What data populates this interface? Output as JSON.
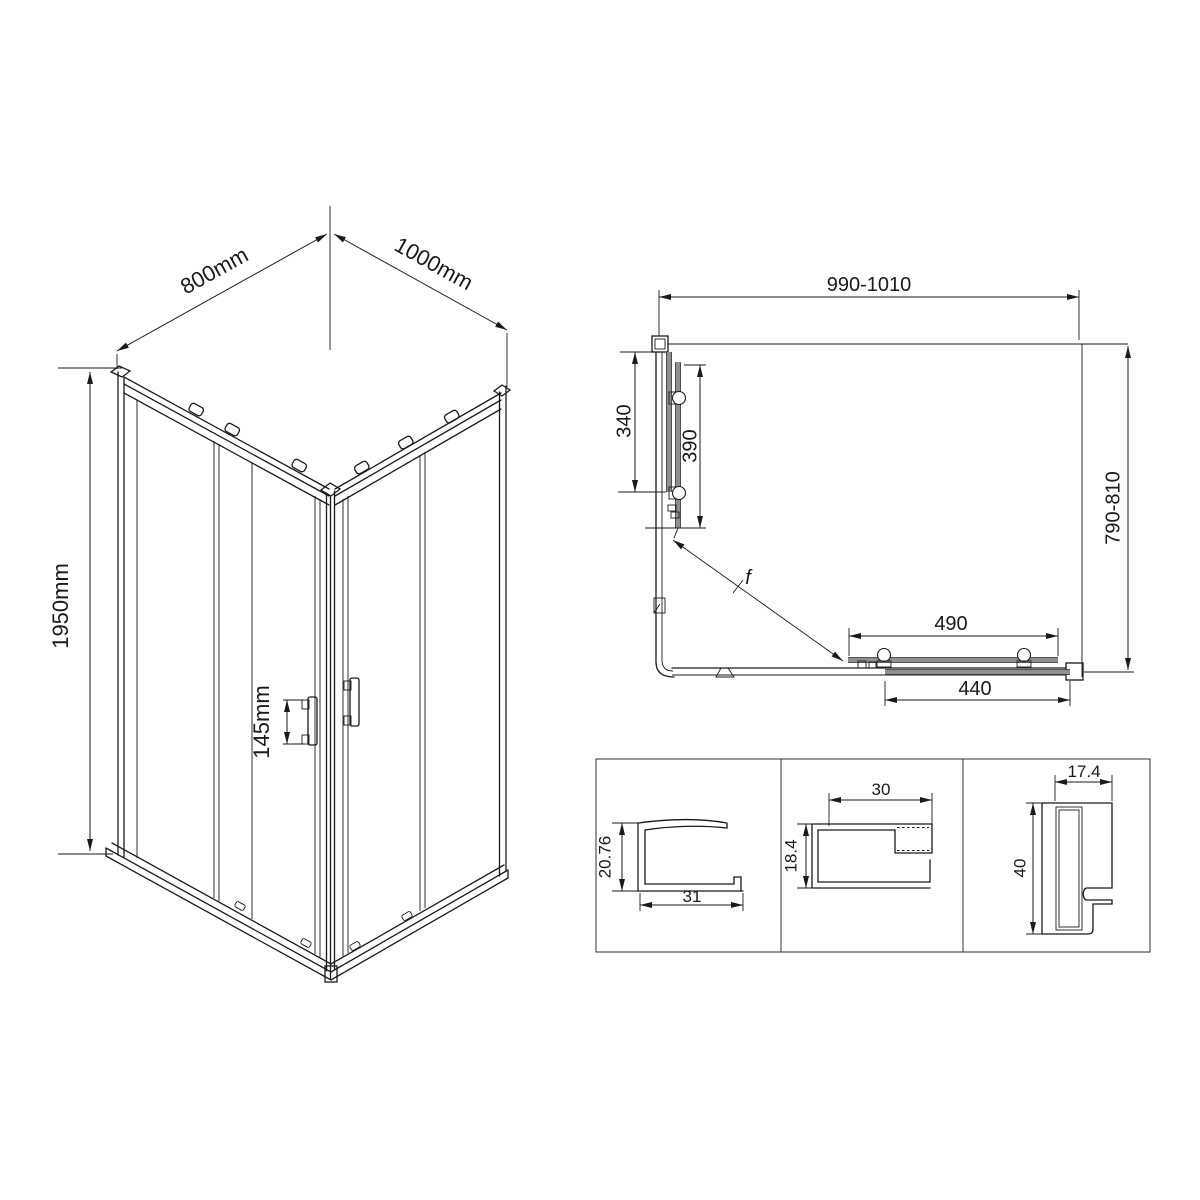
{
  "iso_view": {
    "width_label": "800mm",
    "depth_label": "1000mm",
    "height_label": "1950mm",
    "handle_label": "145mm"
  },
  "plan_view": {
    "width_label": "990-1010",
    "depth_label": "790-810",
    "side_fixed_label": "340",
    "side_door_label": "390",
    "front_door_label": "490",
    "front_fixed_label": "440",
    "section_mark": "f"
  },
  "profiles": {
    "wall_profile": {
      "height_label": "20.76",
      "width_label": "31"
    },
    "frame_profile": {
      "width_label": "30",
      "height_label": "18.4"
    },
    "door_jamb_profile": {
      "width_label": "17.4",
      "height_label": "40"
    }
  },
  "colors": {
    "line": "#1a1a1a",
    "panel_gray": "#8f8f8f",
    "background": "#ffffff"
  }
}
